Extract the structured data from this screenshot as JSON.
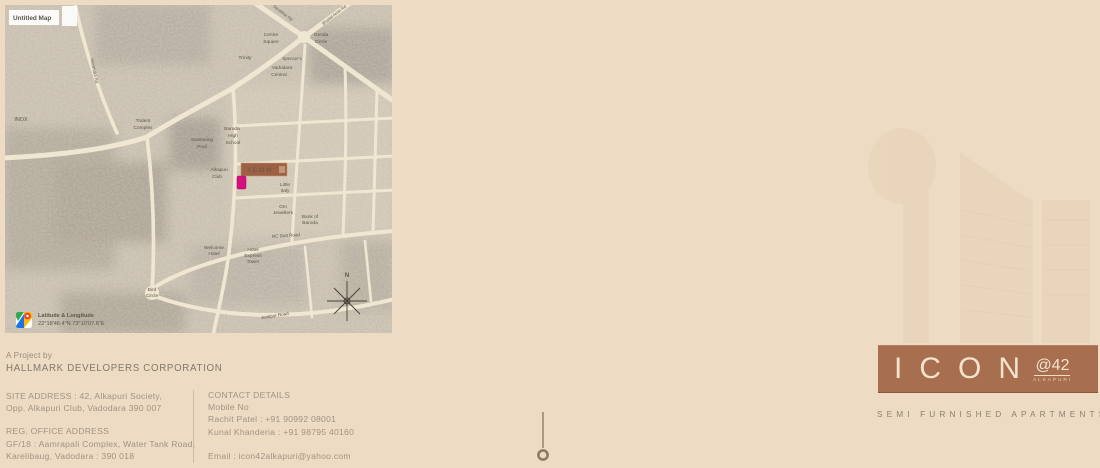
{
  "page": {
    "background": "#eddbc3"
  },
  "map": {
    "untitled_label": "Untitled Map",
    "latitude_label": "Latitude & Longitude",
    "coordinates": "22°18'46.4\"N 73°10'07.6\"E",
    "site_marker": "ICON",
    "colors": {
      "site_marker_box": "#9c6045",
      "pin_marker": "#d4117e",
      "road": "#f0e7d3",
      "base": "#c6bcab"
    },
    "labels": [
      {
        "t": "INOX",
        "x": 21,
        "y": 121,
        "s": 5.4
      },
      {
        "t": "Trident",
        "x": 143,
        "y": 122
      },
      {
        "t": "Complex",
        "x": 143,
        "y": 129
      },
      {
        "t": "Swimming",
        "x": 202,
        "y": 141
      },
      {
        "t": "Pool",
        "x": 202,
        "y": 148
      },
      {
        "t": "Baroda",
        "x": 232,
        "y": 130
      },
      {
        "t": "High",
        "x": 233,
        "y": 137
      },
      {
        "t": "School",
        "x": 233,
        "y": 144
      },
      {
        "t": "Alkapuri",
        "x": 219,
        "y": 171
      },
      {
        "t": "Club",
        "x": 217,
        "y": 178
      },
      {
        "t": "Centre",
        "x": 271,
        "y": 36
      },
      {
        "t": "Square",
        "x": 271,
        "y": 43
      },
      {
        "t": "Trinity",
        "x": 245,
        "y": 59
      },
      {
        "t": "Spencer's",
        "x": 292,
        "y": 60,
        "s": 4.4
      },
      {
        "t": "Vadodara",
        "x": 282,
        "y": 69
      },
      {
        "t": "Central",
        "x": 279,
        "y": 76
      },
      {
        "t": "Genda",
        "x": 321,
        "y": 36
      },
      {
        "t": "Circle",
        "x": 321,
        "y": 43
      },
      {
        "t": "Little",
        "x": 285,
        "y": 186
      },
      {
        "t": "Italy",
        "x": 285,
        "y": 192
      },
      {
        "t": "Om",
        "x": 283,
        "y": 208
      },
      {
        "t": "Jewellers",
        "x": 283,
        "y": 214
      },
      {
        "t": "Bank of",
        "x": 310,
        "y": 218
      },
      {
        "t": "Baroda",
        "x": 310,
        "y": 224
      },
      {
        "t": "Welcome",
        "x": 214,
        "y": 249
      },
      {
        "t": "Hotel",
        "x": 214,
        "y": 255
      },
      {
        "t": "Hotel",
        "x": 253,
        "y": 251
      },
      {
        "t": "Express",
        "x": 253,
        "y": 257
      },
      {
        "t": "Tower",
        "x": 253,
        "y": 263
      },
      {
        "t": "Bird",
        "x": 152,
        "y": 291
      },
      {
        "t": "Circle",
        "x": 152,
        "y": 297
      },
      {
        "t": "RC Dutt Road",
        "x": 286,
        "y": 237,
        "r": -4,
        "s": 4.5
      },
      {
        "t": "Jetalpur Road",
        "x": 275,
        "y": 317,
        "r": -9,
        "s": 4.5
      },
      {
        "t": "Sarabhai Rd",
        "x": 282,
        "y": 14,
        "r": 38,
        "s": 4.2
      },
      {
        "t": "Bhailal Amin Rd",
        "x": 335,
        "y": 16,
        "r": -38,
        "s": 4.2
      },
      {
        "t": "Haribhakti Rd",
        "x": 93,
        "y": 71,
        "r": 78,
        "s": 4.2
      },
      {
        "t": "N",
        "x": 347,
        "y": 277,
        "s": 6,
        "b": true
      }
    ]
  },
  "project": {
    "prefix": "A Project by",
    "company": "HALLMARK DEVELOPERS CORPORATION"
  },
  "addresses": {
    "site_lines": [
      "SITE ADDRESS : 42, Alkapuri Society,",
      "Opp. Alkapuri Club, Vadodara 390 007"
    ],
    "office_lines": [
      "REG. OFFICE ADDRESS",
      "GF/18 : Aamrapali Complex, Water Tank Road,",
      "Karelibaug, Vadodara : 390 018"
    ]
  },
  "contact": {
    "lines": [
      "CONTACT DETAILS",
      "Mobile No",
      "Rachit Patel : +91 90992 08001",
      "Kunal Khanderia : +91 98795 40160"
    ],
    "email": "Email : icon42alkapuri@yahoo.com"
  },
  "logo": {
    "name": "ICON",
    "at": "@42",
    "location": "ALKAPURI",
    "tagline": "SEMI FURNISHED APARTMENTS",
    "box_color": "#a76e50",
    "text_color": "#f4e3cb"
  }
}
